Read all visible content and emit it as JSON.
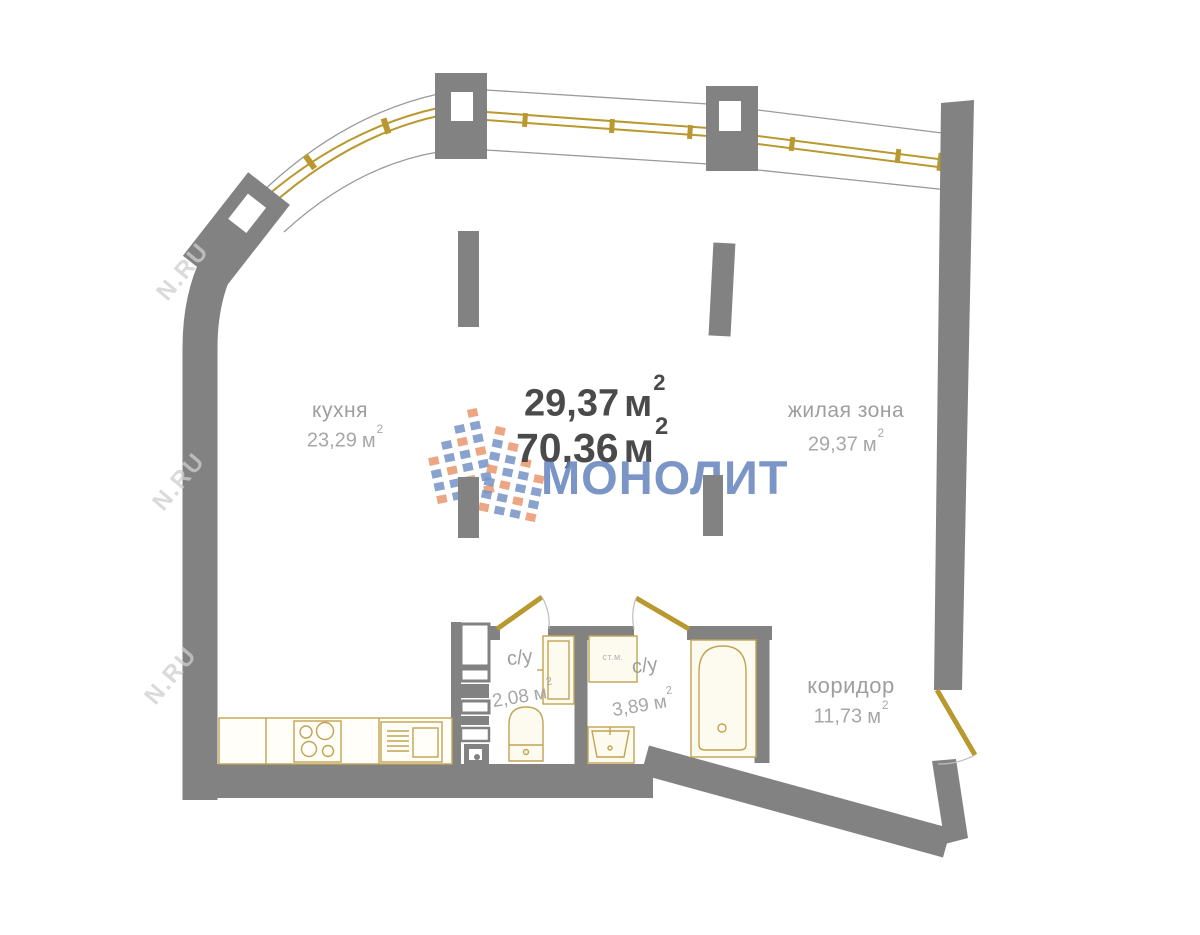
{
  "brand": {
    "name": "МОНОЛИТ"
  },
  "watermark": {
    "text": "N.RU"
  },
  "totals": {
    "living_area": "29,37",
    "total_area": "70,36",
    "unit": "м",
    "sup": "2"
  },
  "rooms": [
    {
      "name": "кухня",
      "area": "23,29",
      "unit": "м",
      "sup": "2"
    },
    {
      "name": "жилая зона",
      "area": "29,37",
      "unit": "м",
      "sup": "2"
    },
    {
      "name": "коридор",
      "area": "11,73",
      "unit": "м",
      "sup": "2"
    },
    {
      "name": "с/у",
      "area": "2,08",
      "unit": "м",
      "sup": "2"
    },
    {
      "name": "с/у",
      "area": "3,89",
      "unit": "м",
      "sup": "2"
    }
  ],
  "appliances": {
    "washing_machine": "ст.м."
  },
  "colors": {
    "wall": "#828282",
    "fixture_outline": "#c2a351",
    "fixture_fill": "#fdfbf0",
    "window_gold": "#b9992f",
    "band_line": "#9a9a9a",
    "logo_blue": "#7493c5",
    "logo_orange": "#e9976e",
    "brand_text": "#6483bd",
    "label_text": "#9e9e9e",
    "area_strong": "#4a4a4a"
  }
}
